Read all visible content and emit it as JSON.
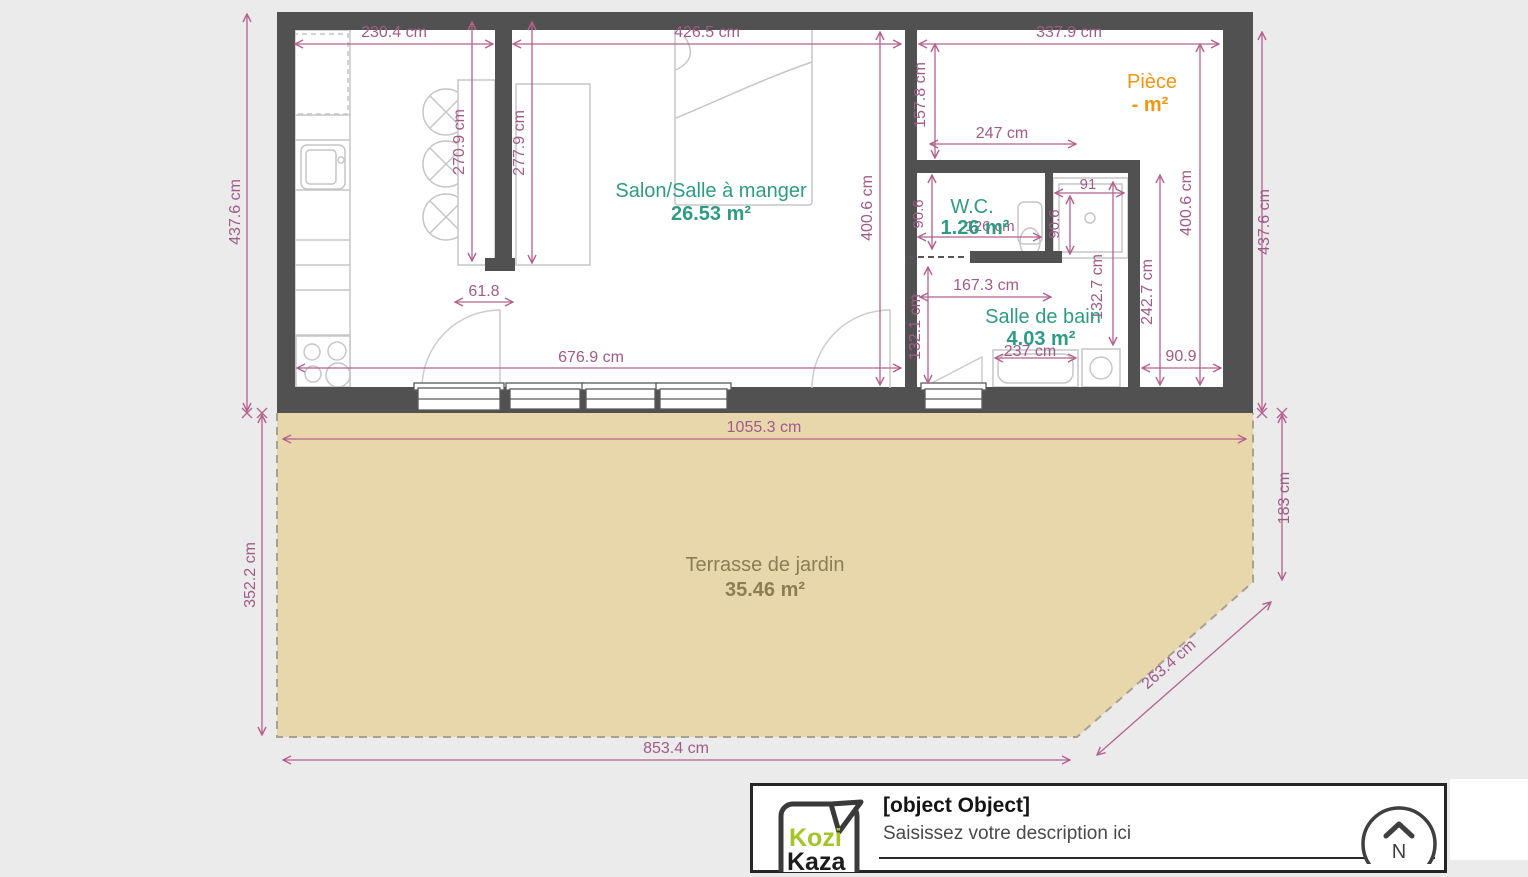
{
  "plan": {
    "rooms": {
      "salon": {
        "name": "Salon/Salle à manger",
        "area": "26.53 m²"
      },
      "piece": {
        "name": "Pièce",
        "area": "- m²"
      },
      "wc": {
        "name": "W.C.",
        "area": "1.26 m²"
      },
      "salle_de_bain": {
        "name": "Salle de bain",
        "area": "4.03 m²"
      },
      "terrasse": {
        "name": "Terrasse de jardin",
        "area": "35.46 m²"
      }
    },
    "dimensions": {
      "top_left": "230.4 cm",
      "top_mid": "426.5 cm",
      "top_right": "337.9 cm",
      "left_outer": "437.6 cm",
      "left_terrace": "352.2 cm",
      "right_outer": "437.6 cm",
      "right_terrace": "183 cm",
      "terrace_diag": "263.4 cm",
      "terrace_top": "1055.3 cm",
      "terrace_bottom": "853.4 cm",
      "salon_height": "400.6 cm",
      "salon_width": "676.9 cm",
      "bar_left": "270.9 cm",
      "bar_right": "277.9 cm",
      "bar_width": "61.8",
      "piece_height": "157.8 cm",
      "piece_width": "247 cm",
      "wc_height": "90.6",
      "wc_width": "126 cm",
      "shower_width": "91",
      "shower_height": "90.6",
      "sdb_width": "167.3 cm",
      "sdb_left_height": "132.1 cm",
      "sdb_mid_height": "132.7 cm",
      "sdb_bottom": "237 cm",
      "corridor_height": "242.7 cm",
      "right_inner_height": "400.6 cm",
      "corridor_width": "90.9"
    },
    "colors": {
      "background": "#ebebeb",
      "wall": "#515151",
      "dimension_line": "#b4618e",
      "dimension_text": "#a25a88",
      "room_label_green": "#2e9c85",
      "piece_label_orange": "#f0960f",
      "terrasse_label": "#8d7d56",
      "terrasse_fill": "#e8d7aa",
      "furniture_outline": "#c6c6c6",
      "logo_green": "#a3c626"
    }
  },
  "footer": {
    "title": "[object Object]",
    "description_placeholder": "Saisissez votre description ici",
    "logo_top": "Kozi",
    "logo_bottom": "Kaza",
    "compass_n": "N"
  }
}
